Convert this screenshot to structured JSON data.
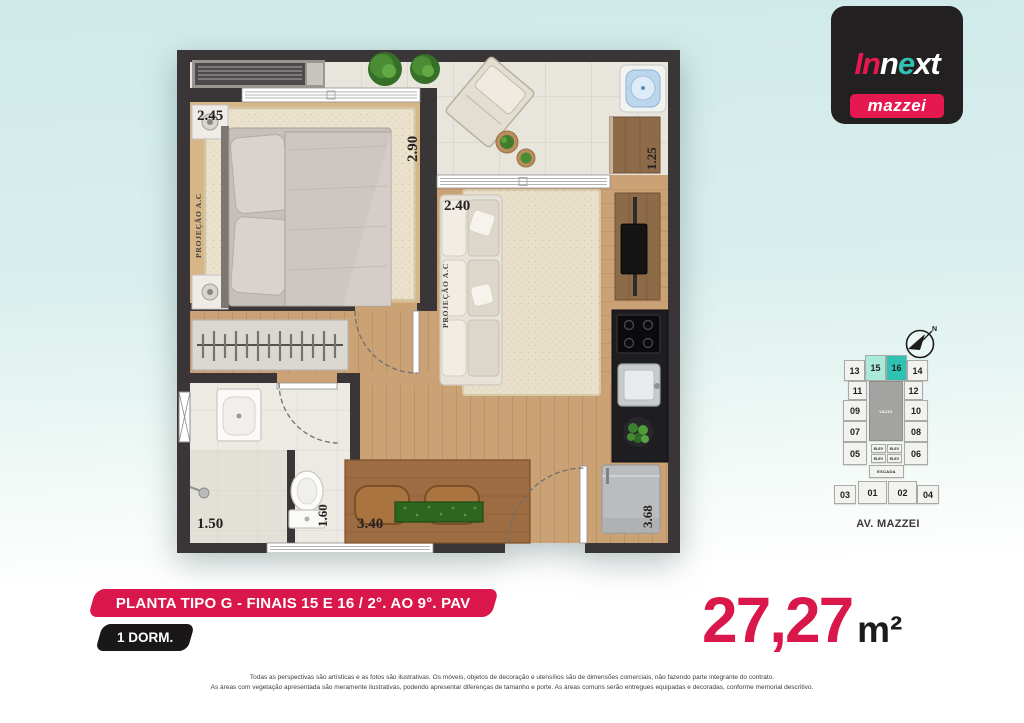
{
  "brand": {
    "part_in": "In",
    "part_n": "n",
    "part_e": "e",
    "part_xt": "xt",
    "subbrand": "mazzei"
  },
  "floorplan": {
    "labels": {
      "bedroom_width": "2.45",
      "bedroom_depth": "2.90",
      "living_width": "2.40",
      "terrace_depth": "1.25",
      "bath_width": "1.50",
      "bath_depth": "1.60",
      "dining_width": "3.40",
      "kitchen_depth": "3.68",
      "ac_projection_bedroom": "PROJEÇÃO A.C",
      "ac_projection_living": "PROJEÇÃO A.C"
    }
  },
  "keyplan": {
    "units": [
      {
        "label": "13"
      },
      {
        "label": "15"
      },
      {
        "label": "16"
      },
      {
        "label": "14"
      },
      {
        "label": "11"
      },
      {
        "label": "12"
      },
      {
        "label": "09"
      },
      {
        "label": "10"
      },
      {
        "label": "07"
      },
      {
        "label": "08"
      },
      {
        "label": "05"
      },
      {
        "label": "06"
      },
      {
        "label": "03"
      },
      {
        "label": "01"
      },
      {
        "label": "02"
      },
      {
        "label": "04"
      }
    ],
    "highlighted_units": [
      "15",
      "16"
    ],
    "core": {
      "vazio": "VAZIO",
      "elev": "ELEV",
      "escada": "ESCADA"
    },
    "street": "AV. MAZZEI",
    "compass": "N"
  },
  "banner": {
    "title": "PLANTA TIPO G - FINAIS 15 E 16 / 2°. AO 9°. PAV",
    "tag": "1 DORM."
  },
  "area": {
    "value": "27,27",
    "unit": "m²"
  },
  "disclaimer": {
    "line1": "Todas as perspectivas são artísticas e as fotos são ilustrativas. Os móveis, objetos de decoração e utensílios são de dimensões comerciais, não fazendo parte integrante do contrato.",
    "line2": "As áreas com vegetação apresentada são meramente ilustrativas, podendo apresentar diferenças de tamanho e porte. As áreas comuns serão entregues equipadas e decoradas, conforme memorial descritivo."
  },
  "colors": {
    "accent": "#D9174B",
    "teal": "#2FC2B4",
    "mint": "#ABE9D9",
    "wall": "#3A3637"
  }
}
